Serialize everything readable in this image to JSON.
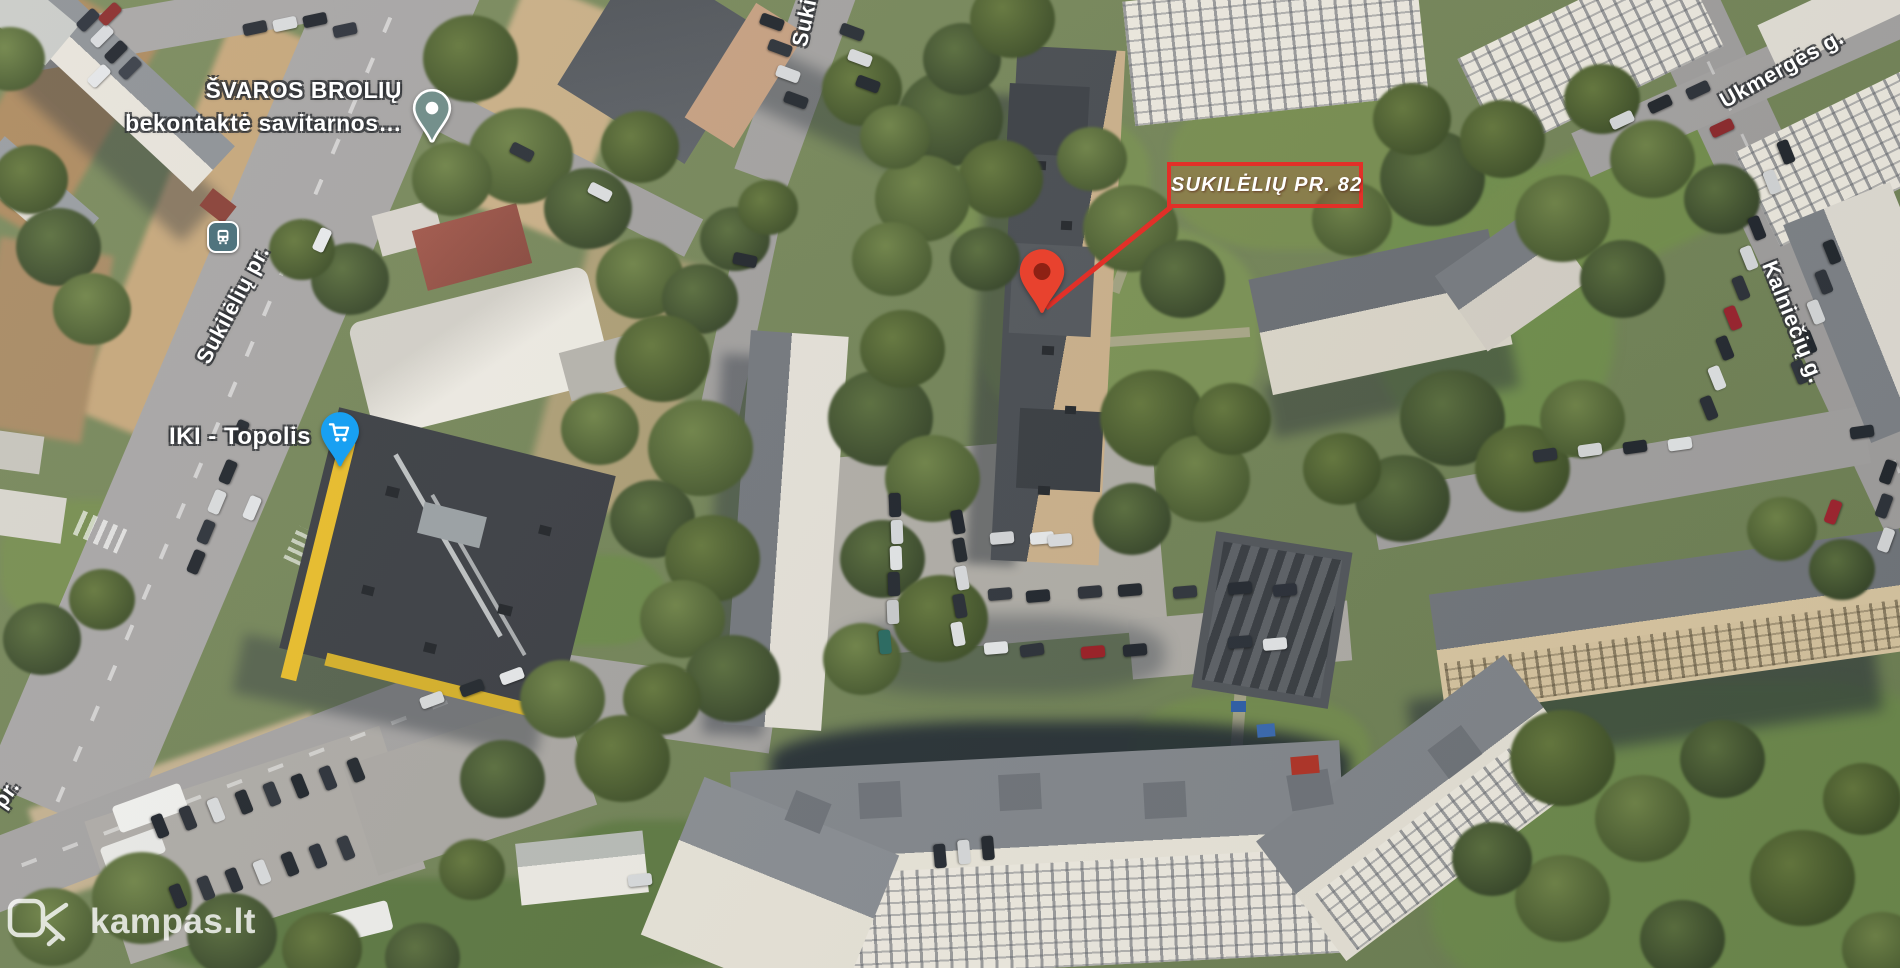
{
  "map_overlay": {
    "poi": {
      "svaros_line1": "ŠVAROS BROLIŲ",
      "svaros_line2": "bekontaktė savitarnos…",
      "iki_label": "IKI - Topolis"
    },
    "streets": {
      "sukileliu_main": "Sukilėlių pr.",
      "sukileliu_top_partial": "Sukilėl",
      "pr_partial": "pr.",
      "ukmerges": "Ukmergės g.",
      "kalnieciu": "Kalniečių g."
    },
    "marker": {
      "label": "SUKILĖLIŲ PR. 82"
    },
    "watermark": {
      "text": "kampas.lt"
    },
    "icons": {
      "bus_stop": "bus-stop-icon",
      "svaros_pin": "place-pin-icon",
      "iki_pin": "shopping-cart-pin-icon",
      "marker_pin": "red-map-pin-icon",
      "watermark_logo": "kampas-logo-icon"
    },
    "colors": {
      "marker_red": "#e23028",
      "marker_pin_fill": "#e8422e",
      "marker_pin_core": "#8e2114",
      "iki_pin_blue": "#18a0f2",
      "svaros_pin_teal": "#74908c",
      "bus_icon_teal": "#50747e"
    }
  }
}
